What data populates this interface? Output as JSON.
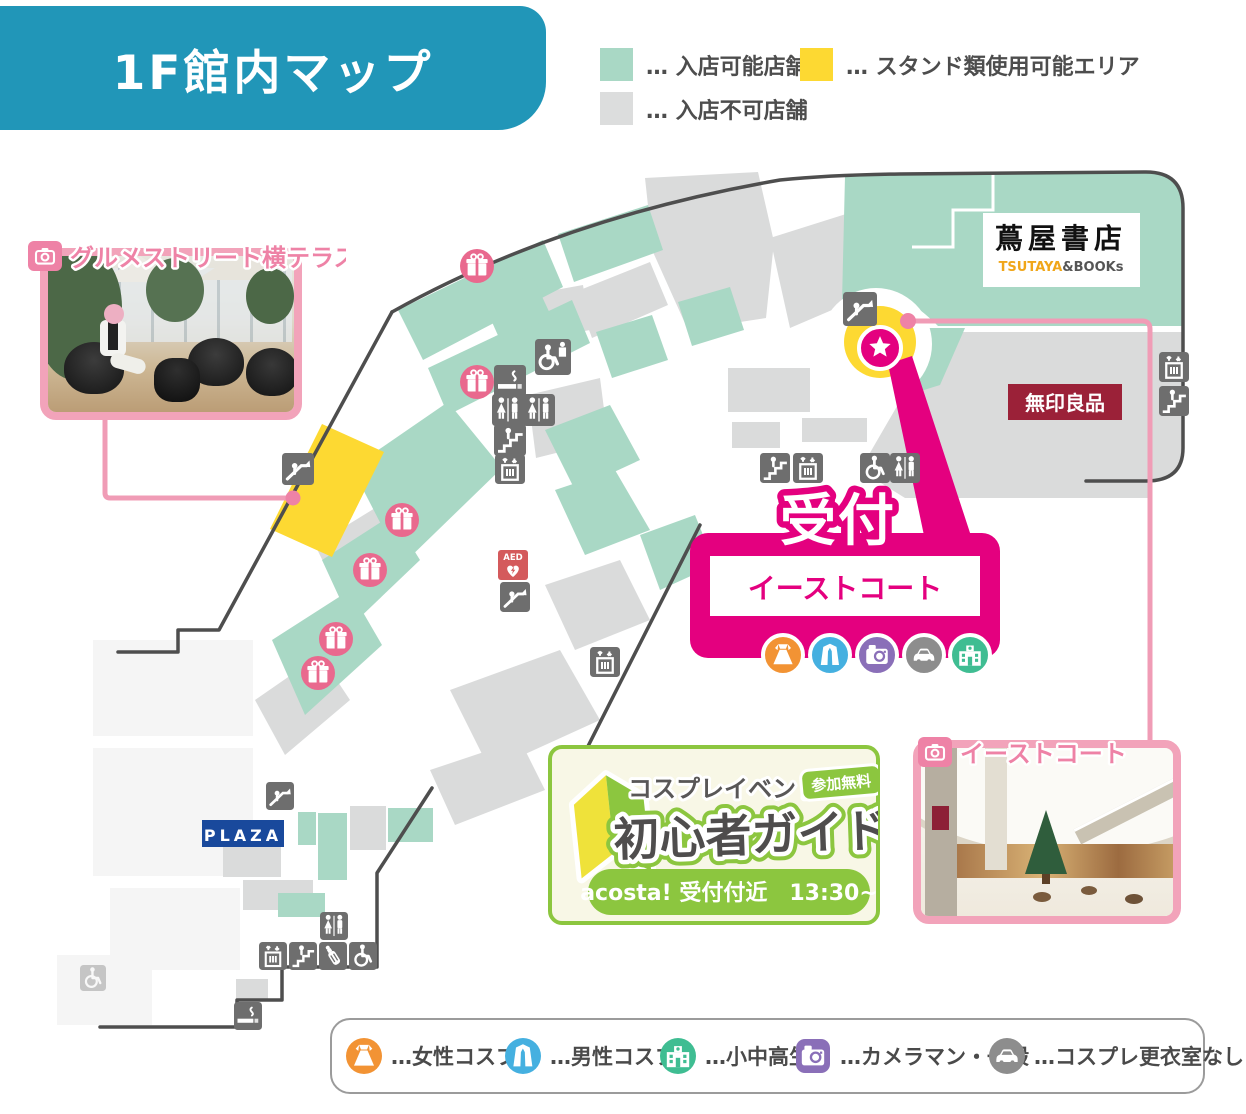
{
  "header": {
    "title": "1F館内マップ"
  },
  "map_legend": {
    "enterable": "… 入店可能店舗",
    "not_enterable": "… 入店不可店舗",
    "stand_ok": "… スタンド類使用可能エリア"
  },
  "stores": {
    "tsutaya": "蔦屋書店",
    "tsutaya_brand": "TSUTAYA",
    "tsutaya_rest": "&BOOKs",
    "muji": "無印良品",
    "plaza": "PLAZA"
  },
  "reception": {
    "title": "受付",
    "place": "イーストコート"
  },
  "photo_cards": {
    "terrace": {
      "label": "グルメストリート横テラス"
    },
    "east_court": {
      "label": "イーストコート"
    }
  },
  "beginner_guide": {
    "event": "コスプレイベント",
    "title": "初心者ガイド",
    "badge": "参加無料",
    "schedule": "acosta! 受付付近　13:30~"
  },
  "attendee_legend": {
    "female": "…女性コスプレ",
    "male": "…男性コスプレ",
    "students": "…小中高生",
    "cameraman": "…カメラマン・一般",
    "no_dressing_room": "…コスプレ更衣室なし"
  },
  "map_icons": {
    "aed": "AED"
  },
  "colors": {
    "header_blue": "#2196b8",
    "enterable_green": "#a9d8c5",
    "not_enterable_gray": "#dcdddd",
    "stand_yellow": "#fdd932",
    "accent_magenta": "#e4007f",
    "photo_pink": "#f2a3ba",
    "guide_green": "#8cc63f",
    "female_orange": "#f29334",
    "male_blue": "#45b0e0",
    "students_green": "#3fbd92",
    "cameraman_purple": "#8a6fb8",
    "no_dressing_gray": "#8d8d8d",
    "muji_red": "#9b2138",
    "plaza_blue": "#19499c"
  }
}
